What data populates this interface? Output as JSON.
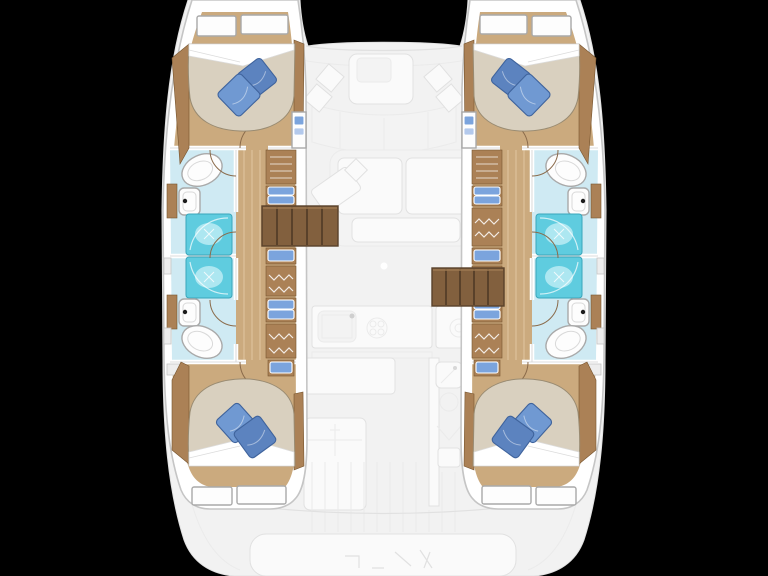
{
  "canvas": {
    "width": 768,
    "height": 576,
    "background": "#000000"
  },
  "palette": {
    "background": "#000000",
    "ghost-base": "#f2f2f2",
    "ghost-line": "#e1e1e1",
    "ghost-line2": "#ebebeb",
    "ghost-fill": "#fafafa",
    "ghost-fill2": "#f3f3f3",
    "hull-white": "#ffffff",
    "hull-outline": "#c5c5c5",
    "wood-floor": "#cbaa7e",
    "wood-plank": "#ddc29b",
    "wood-mid": "#ab8156",
    "wood-edge": "#77552f",
    "stairs": "#82603e",
    "stairs-line": "#59412a",
    "mattress": "#d9d0bf",
    "mattress-edge": "#998b72",
    "sheet": "#ffffff",
    "sheet-edge": "#dcdcdc",
    "pillow": "#7099d2",
    "pillow-dark": "#5c83bf",
    "pillow-edge": "#3f639c",
    "bath-floor": "#cfeaf3",
    "shower": "#5fccdf",
    "shower-light": "#ade7f1",
    "shower-edge": "#3aa6bb",
    "fixture": "#fdfdfd",
    "fixture-edge": "#a9a9a9",
    "fixture-inner": "#d9d9d9",
    "drawer": "#7ba4dd",
    "drawer-light": "#b3c9ec",
    "drawer-edge": "#ffffff",
    "wall": "#ffffff",
    "wall-edge": "#d2d2d2",
    "door-arc": "#8a6a4a",
    "hatch": "#ededed",
    "hatch-edge": "#c6c6c6",
    "faucet": "#1c1c1c"
  },
  "vessel": {
    "kind": "catamaran-layout-plan",
    "hulls": [
      {
        "side": "port",
        "forward_cabin": {
          "bed": "double",
          "pillows": 2,
          "headboard_panels": 2
        },
        "forward_head": {
          "toilet": 1,
          "sink": 1,
          "shower": 1
        },
        "aft_head": {
          "toilet": 1,
          "sink": 1,
          "shower": 1
        },
        "aft_cabin": {
          "bed": "double",
          "pillows": 2,
          "headboard_panels": 2
        },
        "storage": {
          "drawer_units": 4,
          "hanging_lockers": 3,
          "louver_locker": 1
        },
        "companionway_stairs": 1
      },
      {
        "side": "starboard",
        "forward_cabin": {
          "bed": "double",
          "pillows": 2,
          "headboard_panels": 2
        },
        "forward_head": {
          "toilet": 1,
          "sink": 1,
          "shower": 1
        },
        "aft_head": {
          "toilet": 1,
          "sink": 1,
          "shower": 1
        },
        "aft_cabin": {
          "bed": "double",
          "pillows": 2,
          "headboard_panels": 2
        },
        "storage": {
          "drawer_units": 4,
          "hanging_lockers": 3,
          "louver_locker": 1
        },
        "companionway_stairs": 1
      }
    ],
    "bridgedeck_ghosted_features": [
      "forward-cockpit-table",
      "forward-cockpit-bench",
      "cockpit-cushions",
      "salon-sofa",
      "nav-desk",
      "galley-counter-port",
      "galley-sink",
      "stove-burner",
      "galley-counter-starboard",
      "galley-island",
      "wet-bar-sink",
      "wet-bar-burner",
      "aft-cockpit-bench",
      "swim-platform",
      "deck-planking"
    ]
  }
}
